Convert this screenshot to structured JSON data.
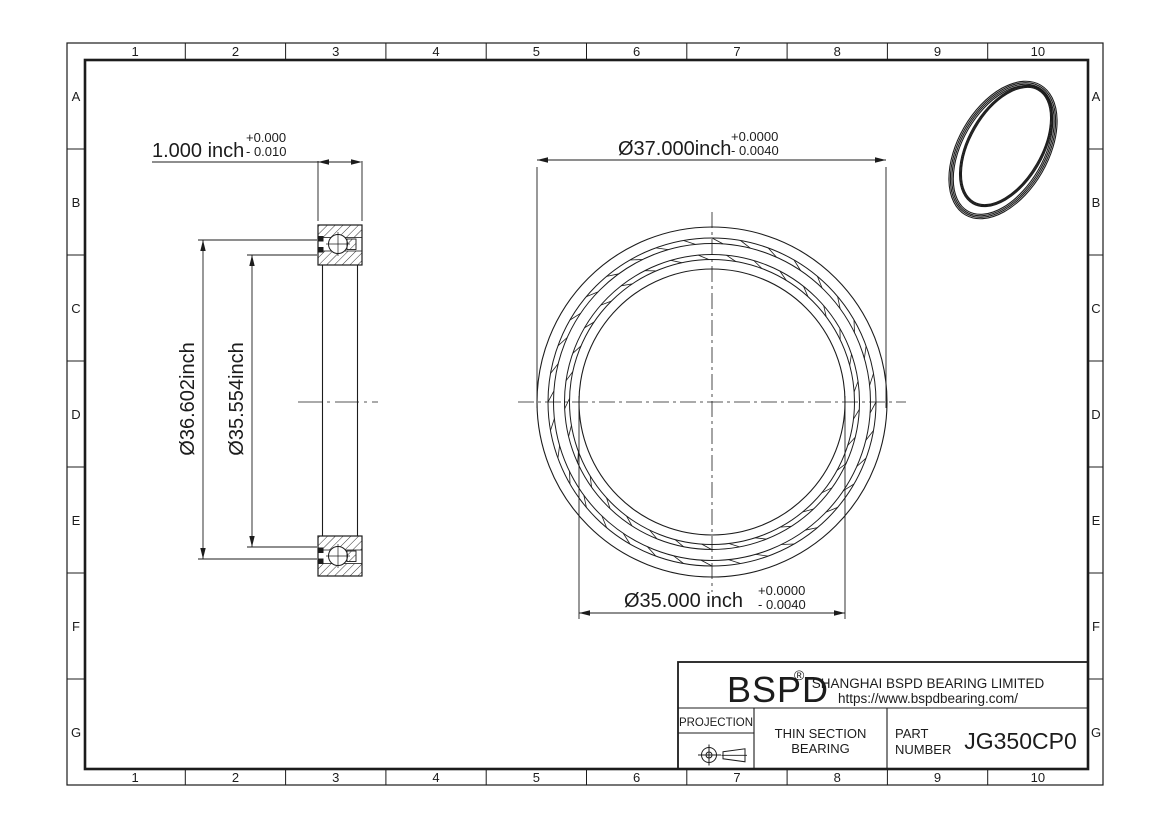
{
  "colors": {
    "line": "#1c1c1c",
    "background": "#ffffff"
  },
  "grid": {
    "cols": [
      "1",
      "2",
      "3",
      "4",
      "5",
      "6",
      "7",
      "8",
      "9",
      "10"
    ],
    "rows": [
      "A",
      "B",
      "C",
      "D",
      "E",
      "F",
      "G"
    ]
  },
  "section_view": {
    "width_dim": {
      "value": "1.000 inch",
      "tol_plus": "+0.000",
      "tol_minus": "- 0.010"
    },
    "outer_race_dim": "Ø36.602inch",
    "inner_race_dim": "Ø35.554inch"
  },
  "front_view": {
    "od_dim": {
      "value": "Ø37.000inch",
      "tol_plus": "+0.0000",
      "tol_minus": "- 0.0040"
    },
    "bore_dim": {
      "value": "Ø35.000 inch",
      "tol_plus": "+0.0000",
      "tol_minus": "- 0.0040"
    }
  },
  "title_block": {
    "logo": "BSPD",
    "registered": "®",
    "company": "SHANGHAI BSPD BEARING LIMITED",
    "website": "https://www.bspdbearing.com/",
    "projection_label": "PROJECTION",
    "product_line1": "THIN SECTION",
    "product_line2": "BEARING",
    "part_label_line1": "PART",
    "part_label_line2": "NUMBER",
    "part_number": "JG350CP0"
  }
}
